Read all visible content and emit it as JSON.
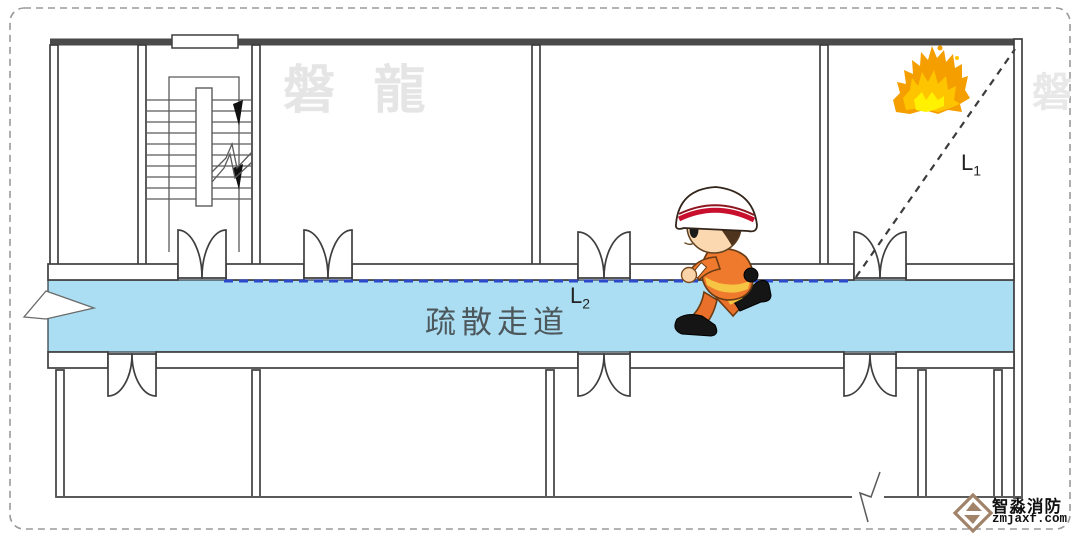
{
  "diagram": {
    "watermark_main": "磐 龍",
    "watermark_side": "磐",
    "corridor_label": "疏散走道",
    "labels": {
      "l1_base": "L",
      "l1_sub": "1",
      "l2_base": "L",
      "l2_sub": "2"
    },
    "colors": {
      "corridor_fill": "#ABDEF2",
      "evacuation_route_line": "#2B49C8",
      "fire_distance_line": "#3C3C3C",
      "wall_outline": "#3F3F3F",
      "flame_outer": "#F59E00",
      "flame_mid": "#FFC400",
      "flame_core": "#FFF100",
      "watermark": "#E5E5E5",
      "brand_logo": "#A1836A",
      "corridor_label_color": "#4D585D"
    }
  },
  "branding": {
    "company_name": "智淼消防",
    "website": "zmjaxf.com"
  }
}
